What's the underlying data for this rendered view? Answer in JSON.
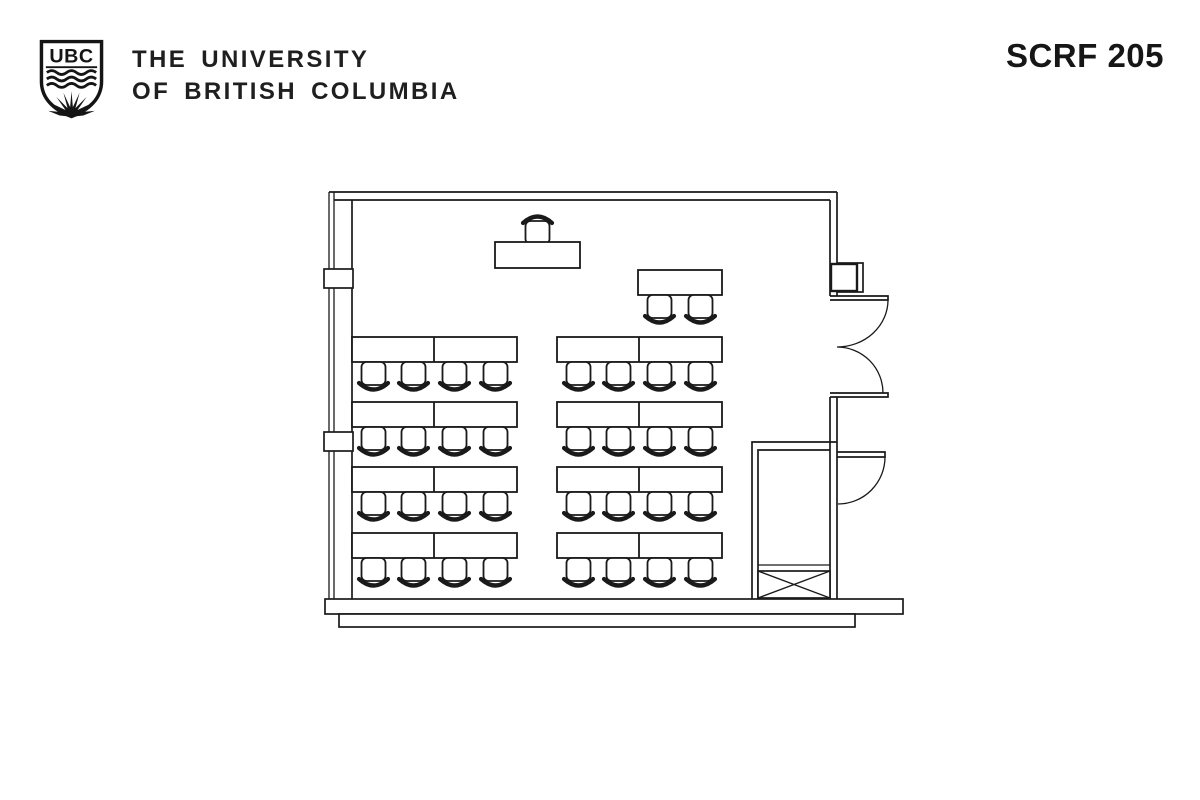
{
  "header": {
    "logo_text": "UBC",
    "institution_line1": "THE UNIVERSITY",
    "institution_line2": "OF BRITISH COLUMBIA",
    "room_label": "SCRF 205"
  },
  "floor_plan": {
    "label": "SCRF 205 classroom floor plan",
    "line_color": "#1a1a1a",
    "capacity": {
      "student_tables": 8,
      "seats_per_table": 4,
      "side_table_seats": 2,
      "instructor_seats": 1,
      "total_seats": 35
    },
    "features": [
      "window-wall",
      "instructor-station",
      "side-table",
      "double-entry-door",
      "single-door",
      "storage-closet",
      "cross-hatched-cabinet"
    ],
    "seating": {
      "table_width": 165,
      "table_height": 25,
      "table_divider": 82,
      "chair_width": 27,
      "chair_height": 30,
      "columns_x": [
        352,
        557
      ],
      "rows_y": [
        337,
        402,
        467,
        533
      ],
      "chair_offsets": [
        8,
        48,
        89,
        130
      ],
      "side_table": {
        "x": 638,
        "y": 270,
        "width": 84,
        "height": 25,
        "chair_offsets": [
          8,
          49
        ]
      },
      "instructor": {
        "table_x": 495,
        "table_y": 242,
        "table_width": 85,
        "table_height": 26,
        "chair_x": 524,
        "chair_y": 214
      }
    }
  }
}
